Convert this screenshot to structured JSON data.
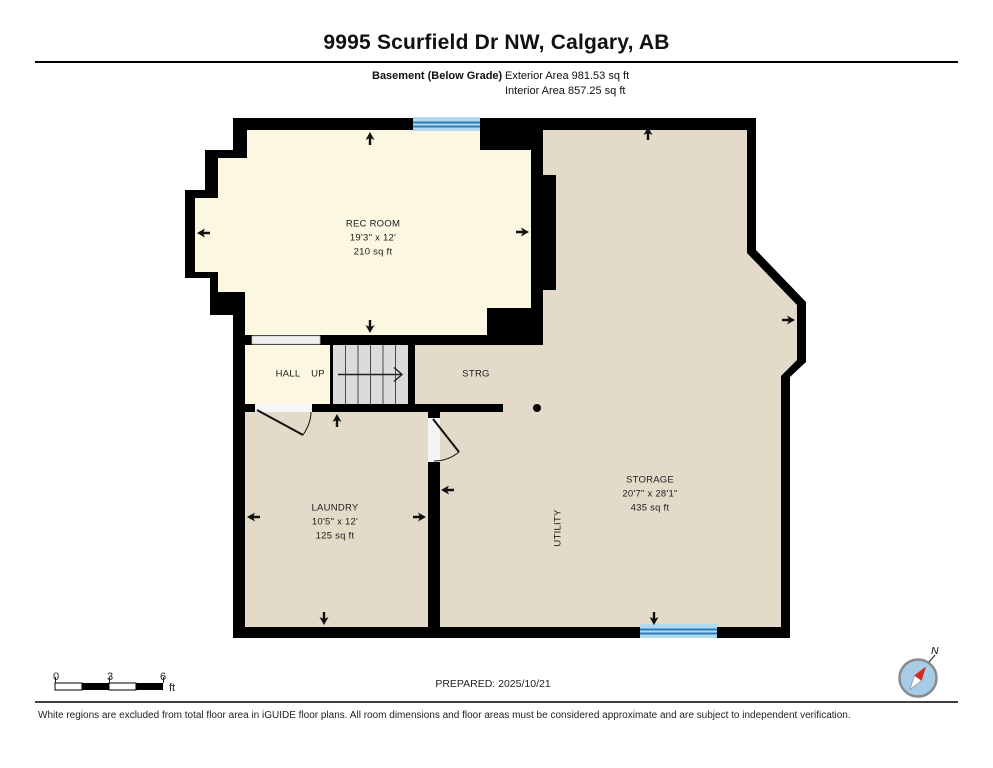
{
  "header": {
    "address": "9995 Scurfield Dr NW, Calgary, AB",
    "floor_label": "Basement (Below Grade)",
    "exterior_area": "Exterior Area 981.53 sq ft",
    "interior_area": "Interior Area 857.25 sq ft"
  },
  "rooms": {
    "rec_room": {
      "name": "REC ROOM",
      "dims": "19'3\" x 12'",
      "area": "210 sq ft"
    },
    "hall": {
      "name": "HALL"
    },
    "stairs": {
      "direction": "UP"
    },
    "strg": {
      "name": "STRG"
    },
    "laundry": {
      "name": "LAUNDRY",
      "dims": "10'5\" x 12'",
      "area": "125 sq ft"
    },
    "storage": {
      "name": "STORAGE",
      "dims": "20'7\" x 28'1\"",
      "area": "435 sq ft"
    },
    "utility": {
      "name": "UTILITY"
    }
  },
  "scale_bar": {
    "start": "0",
    "mid": "3",
    "end": "6",
    "unit": "ft"
  },
  "compass": {
    "north_label": "N"
  },
  "footer": {
    "prepared": "PREPARED: 2025/10/21",
    "disclaimer": "White regions are excluded from total floor area in iGUIDE floor plans. All room dimensions and floor areas must be considered approximate and are subject to independent verification."
  },
  "colors": {
    "finished_floor": "#FCF7E1",
    "unfinished_floor": "#E4DACA",
    "wall": "#000000",
    "window": "#AFD9EE",
    "window_stripe": "#2E7CB8",
    "stairs": "#DBDBDB",
    "opening": "#EFEFEF",
    "compass_fill": "#A6CCE8",
    "compass_needle": "#D42B1E"
  }
}
